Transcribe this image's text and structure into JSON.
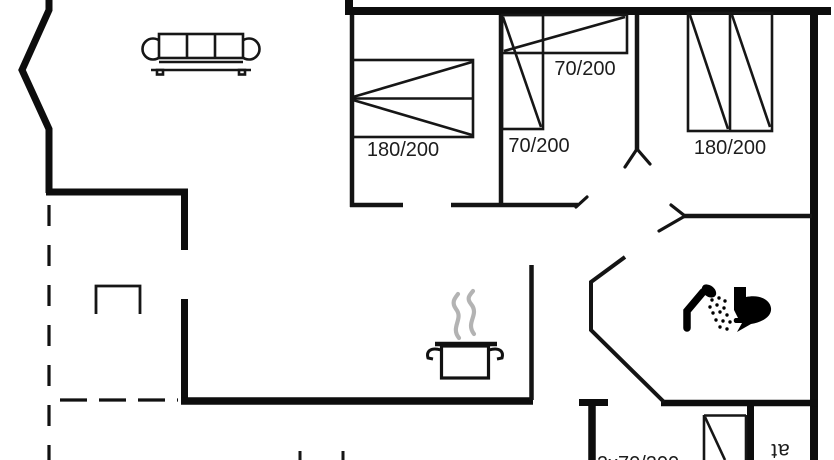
{
  "plan": {
    "type": "floor-plan",
    "colors": {
      "background": "#ffffff",
      "wall": "#0d0d0d",
      "thin_line": "#161616",
      "steam": "#b3b3b3",
      "text": "#1d1d1d"
    },
    "labels": {
      "bed_double_left": "180/200",
      "bed_single_vertical": "70/200",
      "bed_single_top": "70/200",
      "bed_double_right": "180/200",
      "bed_annex_cut": "2x70/200",
      "rotated_fragment": "at"
    },
    "icons": [
      "sofa-icon",
      "cooking-pot-icon",
      "steam-icon",
      "shower-icon",
      "toilet-icon"
    ]
  }
}
